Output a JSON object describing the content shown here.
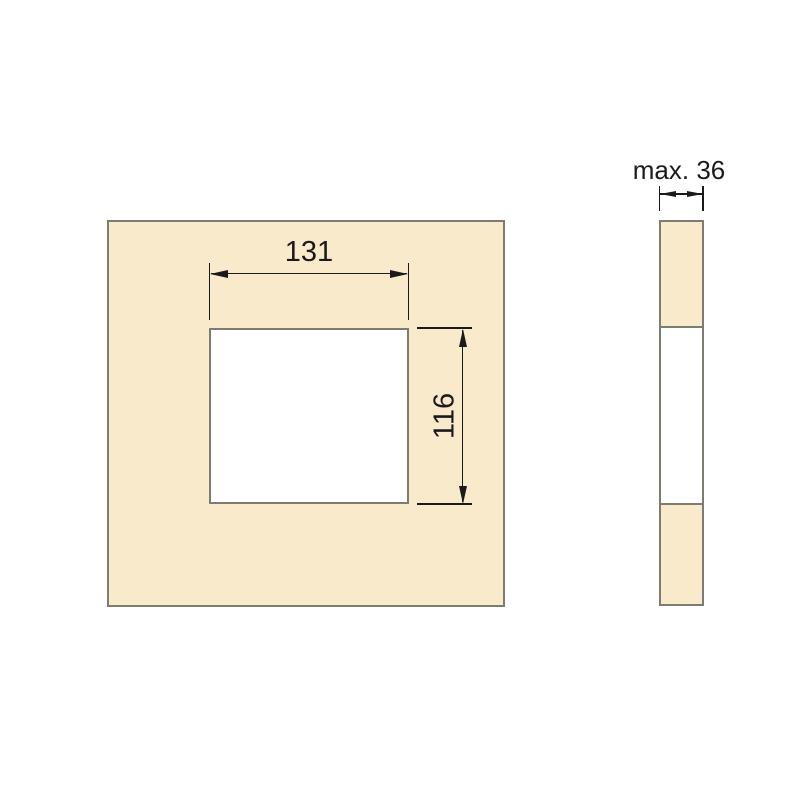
{
  "drawing": {
    "front_view": {
      "cutout_width_dim": {
        "label": "131"
      },
      "cutout_height_dim": {
        "label": "116"
      }
    },
    "side_view": {
      "thickness_dim": {
        "label": "max. 36"
      }
    }
  },
  "colors": {
    "panel_fill": "#FAEACC",
    "outline": "#7D7C72",
    "dimension_line": "#1A1A1A",
    "background": "#FFFFFF"
  }
}
